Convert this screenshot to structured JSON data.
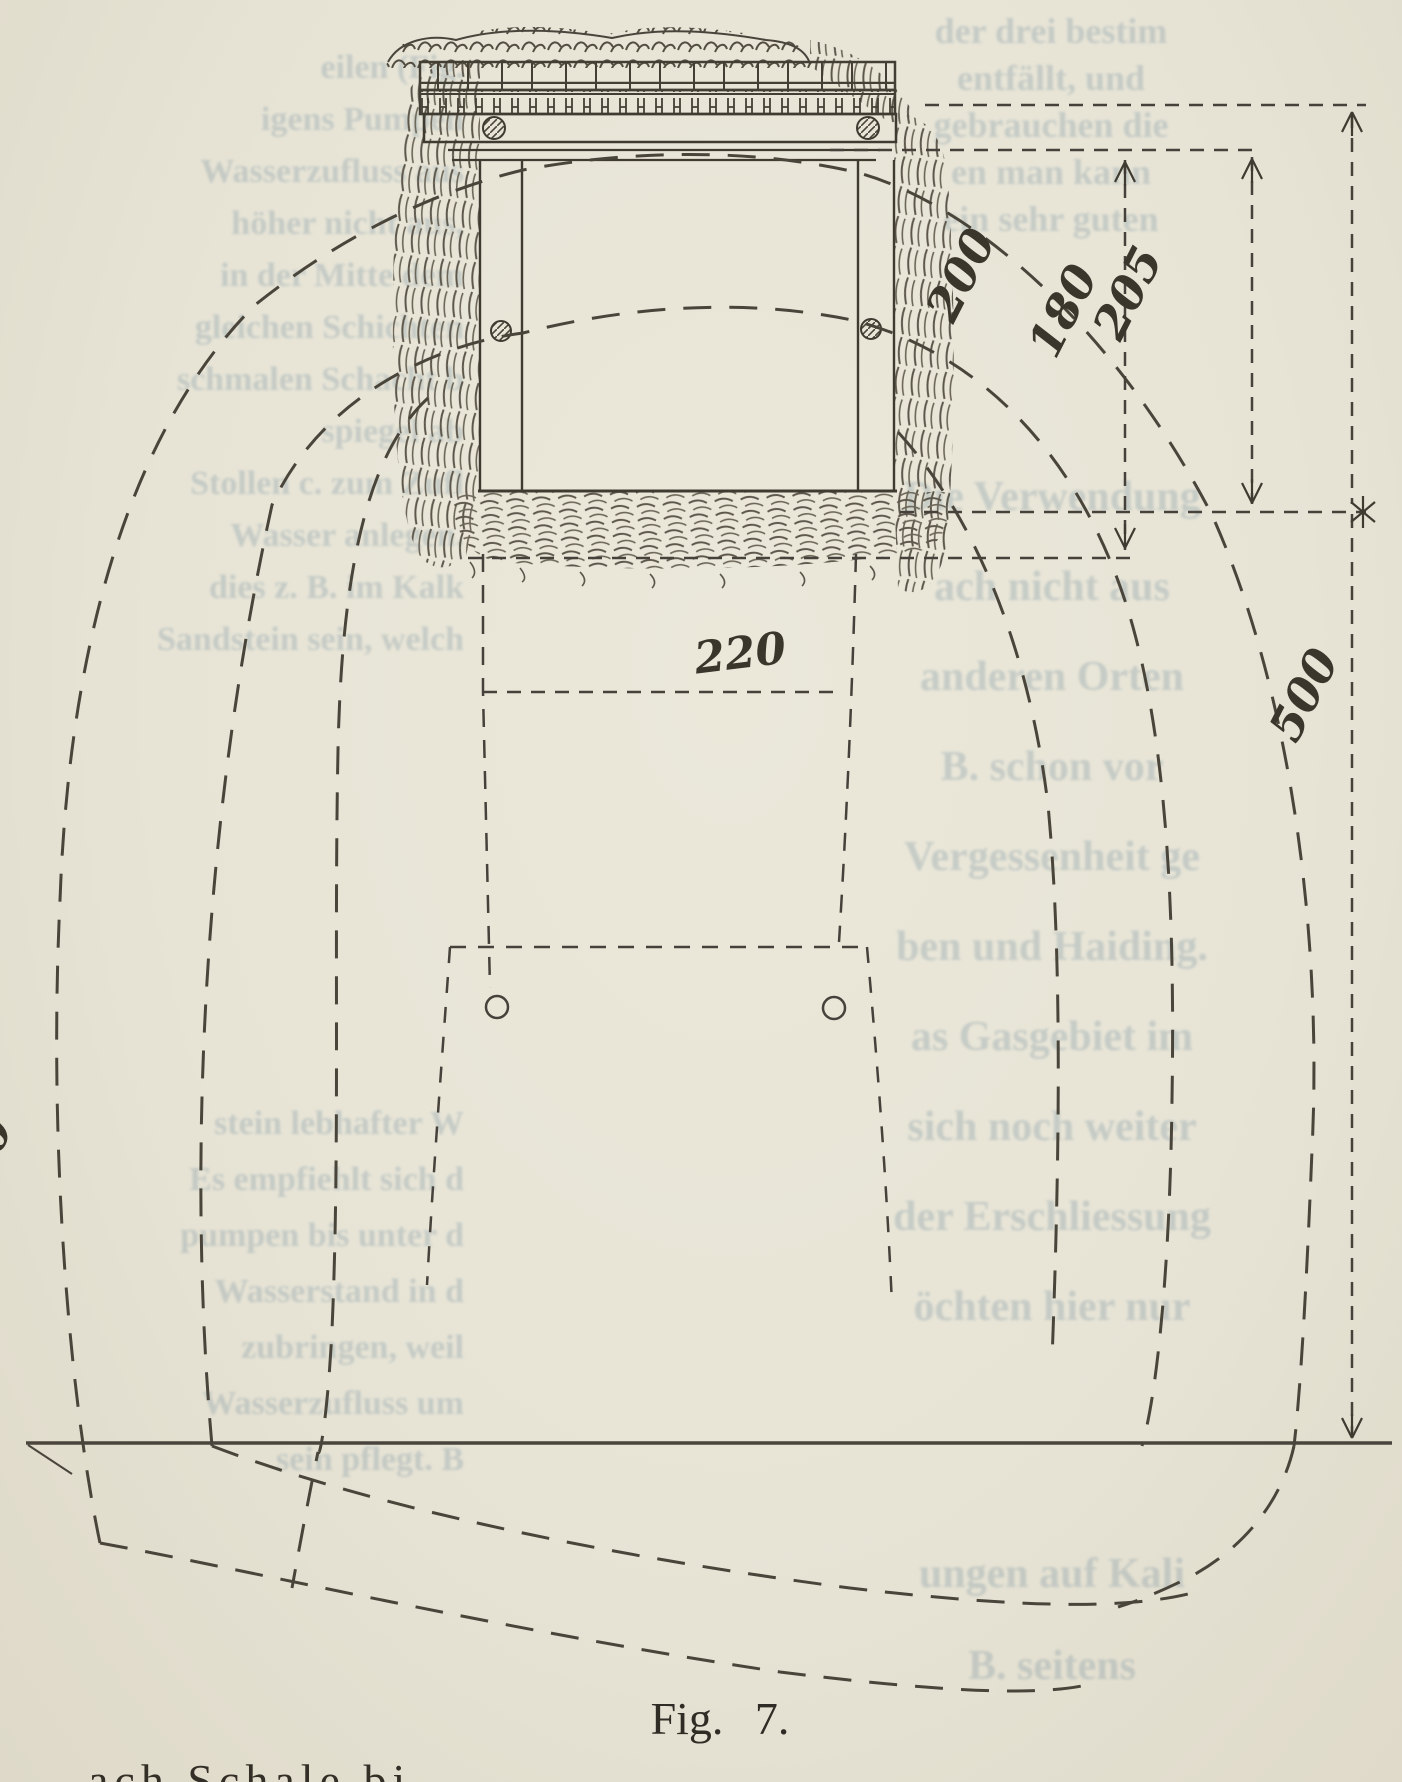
{
  "page": {
    "paper_color": "#e7e4d6",
    "ink_color": "#3f3b31"
  },
  "figure": {
    "caption": "Fig. 7.",
    "labels": {
      "inner_width": "220",
      "height_200": "200",
      "height_180": "180",
      "height_205": "205",
      "depth_500": "500",
      "left_edge_partial": "500"
    }
  },
  "ghost_text": {
    "left_upper": [
      "eilen (Fig.",
      "igens Pumpen",
      "Wasserzufluss aus",
      "höher nicht aus,",
      "in der Mitte dem",
      "gleichen Schichten",
      "schmalen Schacht b",
      "spiegel ab",
      "Stollen c. zum Zufl",
      "Wasser anlegen.",
      "dies z. B. im Kalk",
      "Sandstein sein, welch"
    ],
    "left_lower": [
      "stein lebhafter W",
      "Es empfiehlt sich d",
      "pumpen bis unter d",
      "Wasserstand in d",
      "zubringen, weil",
      "Wasserzufluss um",
      "sein pflegt. B"
    ],
    "right_upper": [
      "der drei bestim",
      "entfällt, und",
      "gebrauchen die",
      "en man kann",
      "ein sehr guten"
    ],
    "right_main": [
      "Die Verwendung",
      "ach nicht aus",
      "anderen Orten",
      "B. schon vor",
      "Vergessenheit ge",
      "ben und Haiding.",
      "as Gasgebiet im",
      "sich noch weiter",
      "der Erschliessung",
      "öchten hier nur"
    ],
    "right_lower": [
      "ungen auf Kali",
      "B. seitens"
    ]
  },
  "bottom_text": "ach Schale bi"
}
